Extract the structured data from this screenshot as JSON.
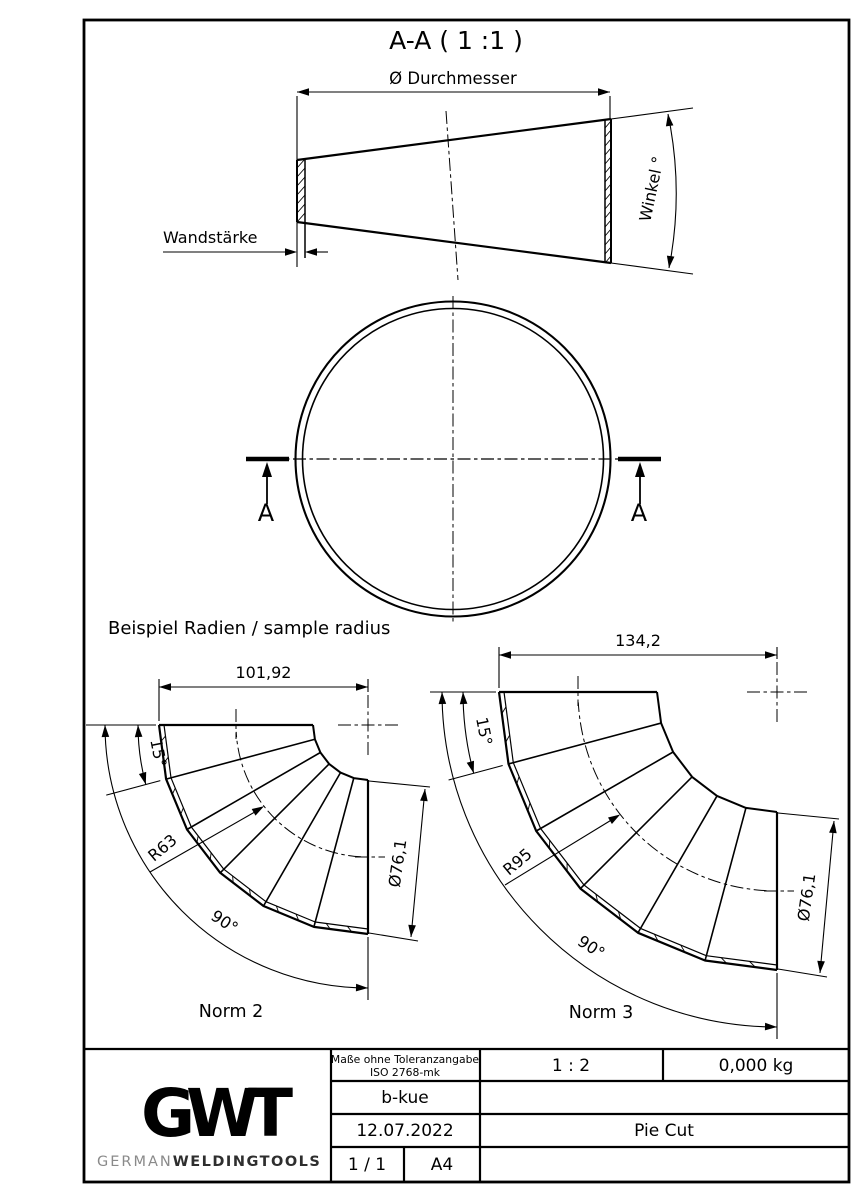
{
  "section_view": {
    "title": "A-A ( 1 :1 )",
    "diameter_label": "Ø Durchmesser",
    "wall_label": "Wandstärke",
    "angle_label": "Winkel °",
    "cut_label": "A"
  },
  "samples": {
    "heading": "Beispiel Radien / sample radius",
    "norm2": {
      "name": "Norm 2",
      "width": "101,92",
      "segment_angle": "15°",
      "bend_radius": "R63",
      "bend_angle": "90°",
      "diameter": "Ø76,1"
    },
    "norm3": {
      "name": "Norm 3",
      "width": "134,2",
      "segment_angle": "15°",
      "bend_radius": "R95",
      "bend_angle": "90°",
      "diameter": "Ø76,1"
    }
  },
  "title_block": {
    "logo": {
      "g": "G",
      "w": "W",
      "t": "T",
      "brand_light": "GERMAN",
      "brand_bold": "WELDINGTOOLS",
      "color_dark": "#3d3d3d",
      "color_mid": "#636363"
    },
    "tolerance_line1": "Maße ohne Toleranzangabe",
    "tolerance_line2": "ISO 2768-mk",
    "scale": "1 : 2",
    "weight": "0,000 kg",
    "author": "b-kue",
    "date": "12.07.2022",
    "part_name": "Pie Cut",
    "sheet": "1 / 1",
    "paper": "A4"
  },
  "colors": {
    "line": "#000000",
    "background": "#ffffff"
  }
}
